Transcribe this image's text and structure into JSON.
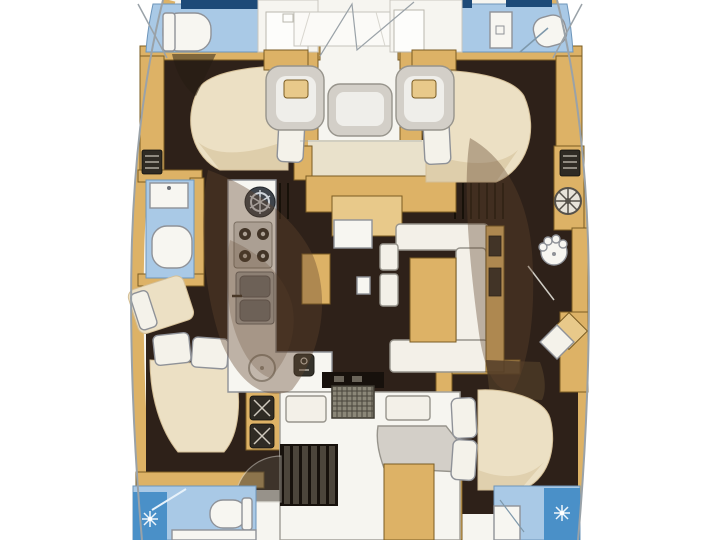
{
  "image": {
    "width": 720,
    "height": 540,
    "kind": "catamaran-floor-plan",
    "text_labels": []
  },
  "colors": {
    "background": "#ffffff",
    "deck": "#f6f5f0",
    "floor_dark": "#2e2119",
    "floor_darker": "#17110c",
    "wood": "#ddb266",
    "wood_light": "#e8c98a",
    "wood_edge": "#7a5c23",
    "head_blue": "#a9c9e6",
    "head_blue_edge": "#6d95ba",
    "navy": "#1d4a78",
    "shower_blue": "#4a90c8",
    "fixture_white": "#f7f6f1",
    "outline_gray": "#8f9298",
    "bed_cream": "#ece0c4",
    "bed_shade": "#d4bf97",
    "pillow": "#f4f2ea",
    "seat_gray": "#d3cfc8",
    "seat_gray_edge": "#97948c",
    "sofa_white": "#f3f0e8",
    "hull_line": "#9aa2a8",
    "icon_dark": "#2f2b24",
    "shadow_brown": "#60452c",
    "cream_band": "#e9e1cb",
    "grate": "#8b8778"
  },
  "regions": [
    "foredeck",
    "port-forward-head",
    "port-forward-shower-compartment",
    "port-forward-cabin",
    "port-mid-head",
    "port-mid-cabin",
    "port-companionway-stairs",
    "port-aft-head",
    "saloon",
    "galley",
    "galley-island",
    "dinette",
    "cockpit",
    "starboard-forward-head",
    "starboard-forward-shower-compartment",
    "starboard-forward-cabin",
    "starboard-corridor",
    "starboard-desk-area",
    "starboard-aft-cabin",
    "starboard-aft-head"
  ],
  "fixtures": [
    "toilet",
    "washbasin",
    "double-sink",
    "round-sink",
    "stove-burners",
    "extractor-dial",
    "shower-spray",
    "bed-with-pillows",
    "sofa",
    "table",
    "steering-wheel",
    "vent-louver",
    "locker",
    "deck-seat",
    "deck-grate",
    "stairs",
    "door-swing"
  ]
}
